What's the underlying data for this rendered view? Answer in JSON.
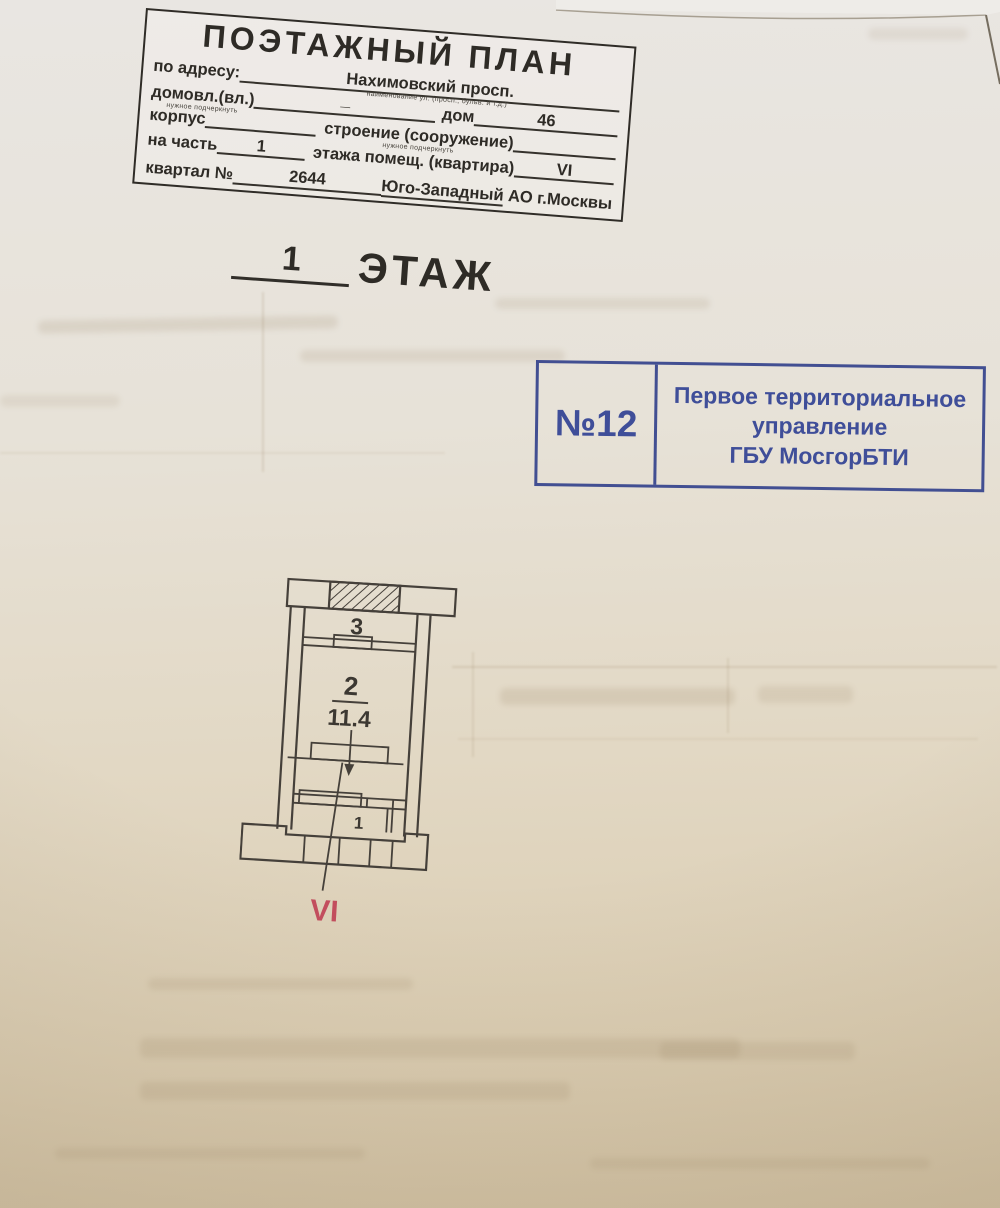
{
  "header_stamp": {
    "title": "ПОЭТАЖНЫЙ ПЛАН",
    "address_label": "по адресу:",
    "address_value": "Нахимовский просп.",
    "address_hint": "наименование ул. (просп., бульв. и т.д.)",
    "ownership_label": "домовл.(вл.)",
    "ownership_hint": "нужное подчеркнуть",
    "ownership_dash": "—",
    "house_label": "дом",
    "house_value": "46",
    "building_label": "корпус",
    "structure_label": "строение (сооружение)",
    "structure_hint": "нужное подчеркнуть",
    "part_label": "на часть",
    "part_value": "1",
    "floor_label": "этажа помещ. (квартира)",
    "apartment_value": "VI",
    "block_label": "квартал №",
    "block_value": "2644",
    "district_underlined": "Юго-Западный",
    "district_rest": " АО г.Москвы"
  },
  "floor_heading": {
    "number": "1",
    "label": "ЭТАЖ"
  },
  "bti_stamp": {
    "number": "№12",
    "line1": "Первое территориальное",
    "line2": "управление",
    "line3": "ГБУ МосгорБТИ",
    "ink_color": "#3a4a96"
  },
  "floor_plan": {
    "rooms": [
      {
        "number": "3"
      },
      {
        "number": "2",
        "area": "11.4"
      },
      {
        "number": "1"
      }
    ],
    "premises_label": "VI",
    "premises_color": "#c44d5e",
    "line_color": "#45403a"
  }
}
